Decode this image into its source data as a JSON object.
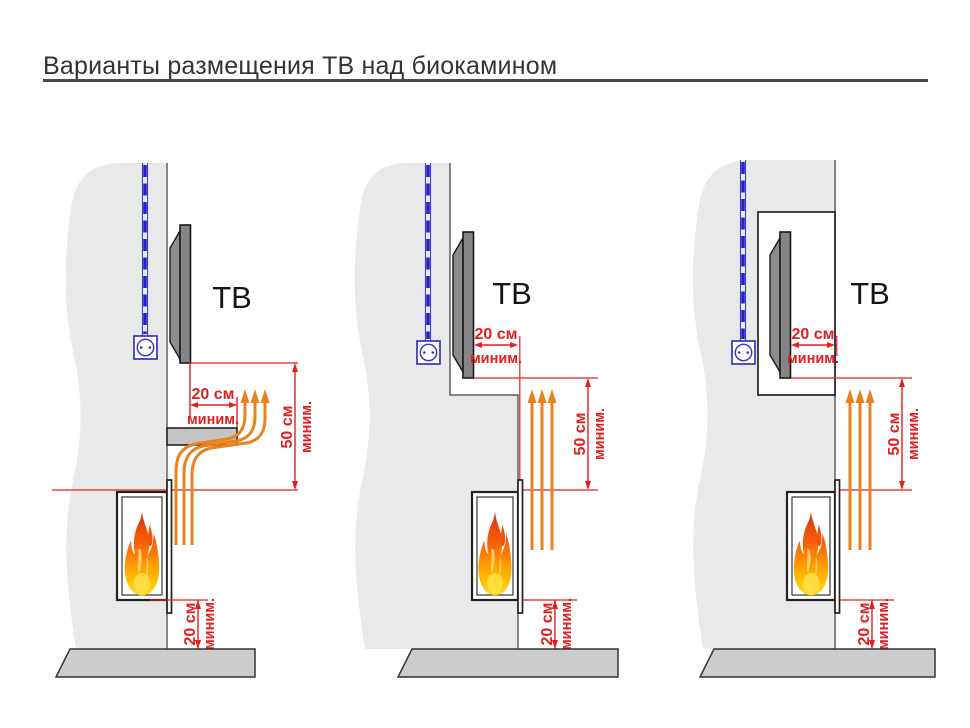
{
  "title": "Варианты размещения ТВ над биокамином",
  "colors": {
    "dimension_red": "#e31e1e",
    "heat_arrow_orange": "#e8821e",
    "cable_blue": "#2323c8",
    "wall_gray": "#e9e9e9",
    "floor_gray": "#cccccc",
    "tv_gray": "#858585"
  },
  "variants": [
    {
      "name": "tv-above-fireplace-with-protective-shelf",
      "tv_label": "ТВ",
      "dims": {
        "top": {
          "value": "20 см",
          "qualifier": "миним."
        },
        "side": {
          "value": "50 см",
          "qualifier": "миним."
        },
        "bottom": {
          "value": "20 см",
          "qualifier": "миним."
        }
      }
    },
    {
      "name": "tv-recessed-behind-fireplace-plane",
      "tv_label": "ТВ",
      "dims": {
        "top": {
          "value": "20 см",
          "qualifier": "миним."
        },
        "side": {
          "value": "50 см",
          "qualifier": "миним."
        },
        "bottom": {
          "value": "20 см",
          "qualifier": "миним."
        }
      }
    },
    {
      "name": "tv-in-wall-niche",
      "tv_label": "ТВ",
      "dims": {
        "top": {
          "value": "20 см",
          "qualifier": "миним."
        },
        "side": {
          "value": "50 см",
          "qualifier": "миним."
        },
        "bottom": {
          "value": "20 см",
          "qualifier": "миним."
        }
      }
    }
  ]
}
